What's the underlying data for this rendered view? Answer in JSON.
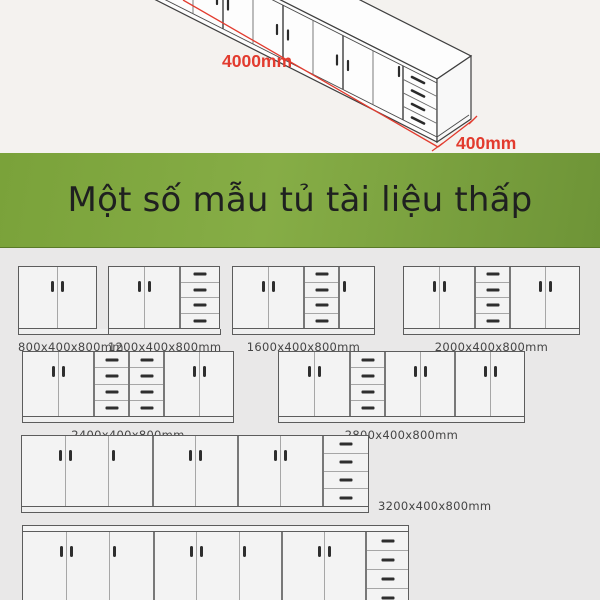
{
  "hero": {
    "length_label": "4000mm",
    "depth_label": "400mm",
    "dimension_color": "#e23b2e"
  },
  "banner": {
    "title": "Một số mẫu tủ tài liệu thấp",
    "background_color": "#7ea73e",
    "text_color": "#1f2020"
  },
  "catalog": {
    "background_color": "#e9e8e8",
    "cabinets": [
      {
        "id": "cabinet-800",
        "label": "800x400x800mm",
        "x": 18,
        "y": 18,
        "h": 61,
        "label_pos": "bottom",
        "sections": [
          {
            "type": "doors",
            "handles": [
              "r",
              "l"
            ],
            "w": 77
          }
        ]
      },
      {
        "id": "cabinet-1200",
        "label": "1200x400x800mm",
        "x": 108,
        "y": 18,
        "h": 61,
        "label_pos": "bottom",
        "sections": [
          {
            "type": "doors",
            "handles": [
              "r",
              "l"
            ],
            "w": 70
          },
          {
            "type": "drawers",
            "w": 40
          }
        ]
      },
      {
        "id": "cabinet-1600",
        "label": "1600x400x800mm",
        "x": 232,
        "y": 18,
        "h": 61,
        "label_pos": "bottom",
        "sections": [
          {
            "type": "doors",
            "handles": [
              "r",
              "l"
            ],
            "w": 70
          },
          {
            "type": "drawers",
            "w": 35
          },
          {
            "type": "doors",
            "handles": [
              "l"
            ],
            "w": 36
          }
        ]
      },
      {
        "id": "cabinet-2000",
        "label": "2000x400x800mm",
        "x": 403,
        "y": 18,
        "h": 61,
        "label_pos": "bottom",
        "sections": [
          {
            "type": "doors",
            "handles": [
              "r",
              "l"
            ],
            "w": 70
          },
          {
            "type": "drawers",
            "w": 35
          },
          {
            "type": "doors",
            "handles": [
              "r",
              "l"
            ],
            "w": 70
          }
        ]
      },
      {
        "id": "cabinet-2400",
        "label": "2400x400x800mm",
        "x": 22,
        "y": 103,
        "h": 64,
        "label_pos": "bottom",
        "sections": [
          {
            "type": "doors",
            "handles": [
              "r",
              "l"
            ],
            "w": 70
          },
          {
            "type": "drawers",
            "w": 35
          },
          {
            "type": "drawers",
            "w": 35
          },
          {
            "type": "doors",
            "handles": [
              "r",
              "l"
            ],
            "w": 70
          }
        ]
      },
      {
        "id": "cabinet-2800",
        "label": "2800x400x800mm",
        "x": 278,
        "y": 103,
        "h": 64,
        "label_pos": "bottom",
        "sections": [
          {
            "type": "doors",
            "handles": [
              "r",
              "l"
            ],
            "w": 70
          },
          {
            "type": "drawers",
            "w": 35
          },
          {
            "type": "doors",
            "handles": [
              "r",
              "l"
            ],
            "w": 70
          },
          {
            "type": "doors",
            "handles": [
              "r",
              "l"
            ],
            "w": 70
          }
        ]
      },
      {
        "id": "cabinet-3200",
        "label": "3200x400x800mm",
        "x": 21,
        "y": 187,
        "h": 70,
        "label_pos": "right",
        "sections": [
          {
            "type": "doors",
            "handles": [
              "r",
              "l",
              "l"
            ],
            "w": 130
          },
          {
            "type": "doors",
            "handles": [
              "r",
              "l"
            ],
            "w": 85
          },
          {
            "type": "doors",
            "handles": [
              "r",
              "l"
            ],
            "w": 85
          },
          {
            "type": "drawers",
            "w": 46
          }
        ]
      },
      {
        "id": "cabinet-3600-clipped",
        "x": 22,
        "y": 277,
        "h": 75,
        "clipped": true,
        "top_strip": true,
        "label_pos": "none",
        "sections": [
          {
            "type": "doors",
            "handles": [
              "r",
              "l",
              "l"
            ],
            "w": 130
          },
          {
            "type": "doors",
            "handles": [
              "r",
              "l",
              "l"
            ],
            "w": 128
          },
          {
            "type": "doors",
            "handles": [
              "r",
              "l"
            ],
            "w": 84
          },
          {
            "type": "drawers",
            "w": 43
          }
        ]
      }
    ]
  }
}
